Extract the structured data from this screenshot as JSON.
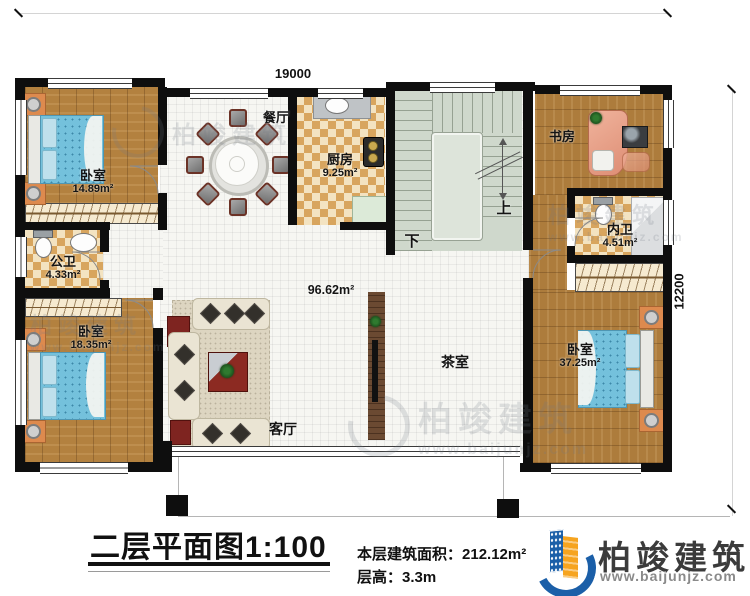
{
  "drawing": {
    "title": "二层平面图1:100",
    "area_label": "本层建筑面积：",
    "area_value": "212.12m²",
    "floor_height_label": "层高：",
    "floor_height_value": "3.3m"
  },
  "brand": {
    "name": "柏竣建筑",
    "website": "www.baijunjz.com",
    "blue": "#1b5fa8",
    "orange": "#f6a41f"
  },
  "dimensions": {
    "width_mm": "19000",
    "depth_mm": "12200"
  },
  "rooms": {
    "bedroom_top_left": {
      "name": "卧室",
      "area": "14.89m²"
    },
    "public_bath": {
      "name": "公卫",
      "area": "4.33m²"
    },
    "bedroom_bottom_left": {
      "name": "卧室",
      "area": "18.35m²"
    },
    "dining": {
      "name": "餐厅"
    },
    "kitchen": {
      "name": "厨房",
      "area": "9.25m²"
    },
    "study": {
      "name": "书房"
    },
    "ensuite_bath": {
      "name": "内卫",
      "area": "4.51m²"
    },
    "bedroom_right": {
      "name": "卧室",
      "area": "37.25m²"
    },
    "tea_room": {
      "name": "茶室"
    },
    "living": {
      "name": "客厅"
    },
    "hall": {
      "area": "96.62m²"
    },
    "stairs": {
      "up": "上",
      "down": "下"
    }
  },
  "watermark": {
    "name": "柏竣建筑",
    "website": "www.baijunjz.com"
  }
}
